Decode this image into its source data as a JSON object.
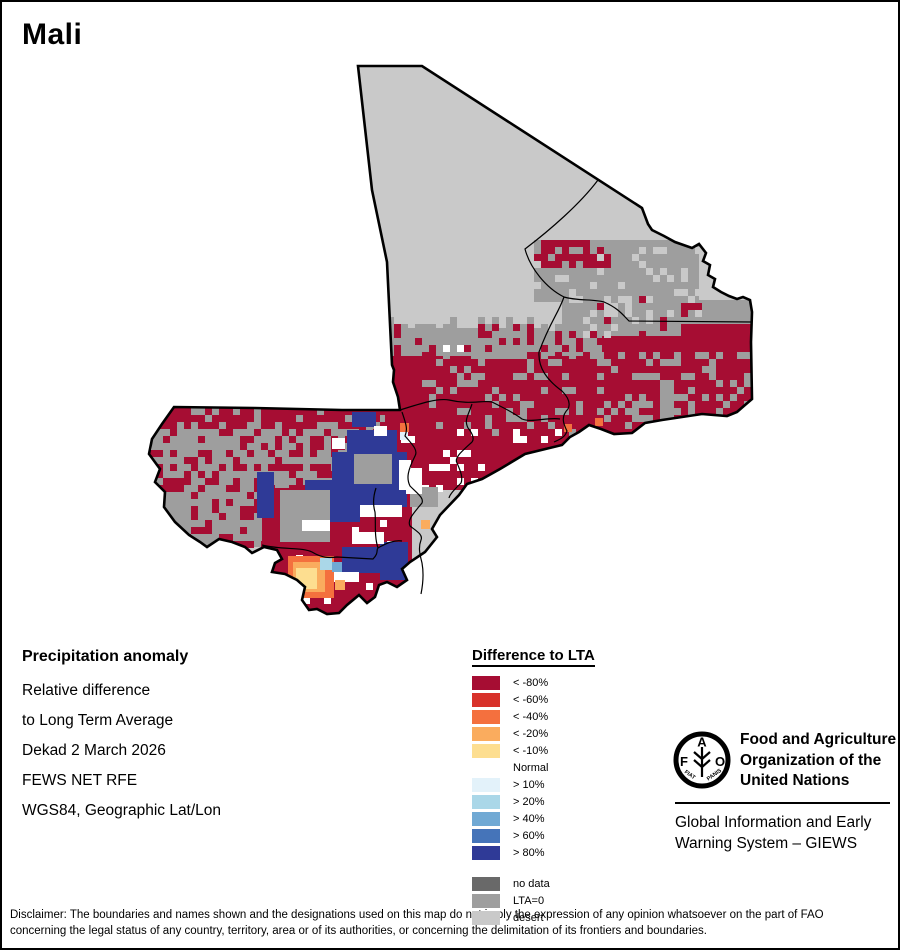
{
  "title": "Mali",
  "info": {
    "heading": "Precipitation anomaly",
    "lines": [
      "Relative difference",
      "to Long Term Average",
      "Dekad 2 March 2026",
      "FEWS NET RFE",
      "WGS84, Geographic Lat/Lon"
    ]
  },
  "legend": {
    "title": "Difference to LTA",
    "entries": [
      {
        "label": "< -80%",
        "color": "#A60D33"
      },
      {
        "label": "< -60%",
        "color": "#D8322B"
      },
      {
        "label": "< -40%",
        "color": "#F4703E"
      },
      {
        "label": "< -20%",
        "color": "#FAAC5E"
      },
      {
        "label": "< -10%",
        "color": "#FDDE90"
      },
      {
        "label": "Normal",
        "color": "#FFFFFF"
      },
      {
        "label": "> 10%",
        "color": "#E3F2FA"
      },
      {
        "label": "> 20%",
        "color": "#AAD7E8"
      },
      {
        "label": "> 40%",
        "color": "#70A9D4"
      },
      {
        "label": "> 60%",
        "color": "#4574B9"
      },
      {
        "label": "> 80%",
        "color": "#2F3A97"
      }
    ],
    "extra_entries": [
      {
        "label": "no data",
        "color": "#696969"
      },
      {
        "label": "LTA=0",
        "color": "#9E9E9E"
      },
      {
        "label": "desert",
        "color": "#C9C9C9"
      }
    ]
  },
  "fao": {
    "logo_letters": [
      "F",
      "A",
      "O"
    ],
    "motto_left": "FIAT",
    "motto_right": "PANIS",
    "org_lines": [
      "Food and Agriculture",
      "Organization of the",
      "United Nations"
    ],
    "giews_lines": [
      "Global Information and Early",
      "Warning System – GIEWS"
    ]
  },
  "disclaimer": {
    "line1": "Disclaimer: The boundaries and names shown and the designations used on this map do not imply the expression of any opinion whatsoever on the part of FAO",
    "line2": "concerning the legal status of any country, territory, area or of its authorities, or concerning the delimitation of its frontiers and boundaries."
  },
  "map": {
    "colors": {
      "desert": "#C9C9C9",
      "lta0": "#9E9E9E",
      "deficit_severe": "#A60D33",
      "surplus_high": "#2F3A97",
      "normal": "#FFFFFF"
    },
    "outline": "M356,64 L420,64 L640,206 L646,222 L650,228 L662,234 L673,240 L690,246 L697,242 L704,251 L701,259 L708,263 L706,273 L713,277 L711,285 L719,290 L727,294 L735,297 L741,295 L748,298 L750,310 L749,340 L750,397 L743,403 L735,410 L725,414 L700,412 L660,418 L643,421 L630,431 L612,432 L599,427 L587,423 L577,430 L568,435 L560,443 L523,452 L498,467 L480,477 L465,482 L457,493 L438,513 L430,527 L435,535 L423,550 L408,560 L400,567 L405,578 L395,585 L385,580 L377,583 L373,595 L365,601 L357,593 L345,603 L337,611 L325,612 L315,607 L307,608 L300,598 L303,585 L295,578 L283,572 L270,570 L273,561 L280,557 L275,548 L262,545 L250,551 L243,545 L230,540 L217,537 L205,545 L198,540 L187,533 L173,520 L162,505 L163,490 L153,480 L158,467 L147,452 L150,437 L160,422 L172,405 L253,406 L340,408 L398,408 L396,395 L391,380 L392,368 L390,363 L385,260 L370,188 Z",
    "boundaries": [
      "M596,178 C578,202 548,228 523,247 C528,266 544,286 562,295 C575,299 592,297 602,300 C616,306 621,313 627,319 L750,320",
      "M562,295 C556,312 548,320 537,350 C536,366 545,378 560,389 C568,397 568,403 566,407 C558,415 562,423 565,429 C563,436 556,438 552,440",
      "M398,408 C420,401 436,396 447,398 C468,403 480,398 490,400 C502,406 512,411 520,417 C530,421 545,415 558,417",
      "M400,410 C404,422 406,427 403,434 C412,444 416,449 413,454 C406,468 404,476 408,484 C416,492 422,496 420,501 C411,512 405,518 408,524 C416,530 421,533 419,538 C416,546 418,553 420,561 C422,572 421,582 419,592",
      "M260,543 C280,548 300,545 310,550 C320,556 327,556 335,555 L371,557 C377,551 374,548 376,546 C386,540 394,538 400,539",
      "M470,402 C466,414 462,418 466,426 C471,432 473,438 469,441 C459,450 452,456 455,461 C459,470 461,476 459,481 C452,488 448,492 447,496",
      "M376,546 C372,534 374,520 373,510 C370,500 372,492 374,486"
    ],
    "solids": [
      {
        "x": 383,
        "y": 326,
        "w": 370,
        "h": 106,
        "c": "#9E9E9E"
      },
      {
        "x": 597,
        "y": 298,
        "w": 156,
        "h": 30,
        "c": "#9E9E9E"
      },
      {
        "x": 150,
        "y": 403,
        "w": 250,
        "h": 142,
        "c": "#9E9E9E"
      },
      {
        "x": 383,
        "y": 354,
        "w": 370,
        "h": 78,
        "c": "#A60D33"
      },
      {
        "x": 600,
        "y": 322,
        "w": 153,
        "h": 34,
        "c": "#A60D33"
      },
      {
        "x": 388,
        "y": 432,
        "w": 180,
        "h": 56,
        "c": "#A60D33"
      },
      {
        "x": 260,
        "y": 486,
        "w": 150,
        "h": 126,
        "c": "#A60D33"
      },
      {
        "x": 532,
        "y": 238,
        "w": 165,
        "h": 62,
        "c": "#9E9E9E"
      },
      {
        "x": 560,
        "y": 296,
        "w": 120,
        "h": 38,
        "c": "#9E9E9E"
      }
    ],
    "speckles": [
      {
        "x": 383,
        "y": 328,
        "w": 370,
        "h": 28,
        "c": "#A60D33",
        "d": 0.32,
        "seed": 21
      },
      {
        "x": 597,
        "y": 300,
        "w": 100,
        "h": 26,
        "c": "#A60D33",
        "d": 0.22,
        "seed": 31
      },
      {
        "x": 420,
        "y": 352,
        "w": 333,
        "h": 82,
        "c": "#9E9E9E",
        "d": 0.2,
        "seed": 22
      },
      {
        "x": 428,
        "y": 334,
        "w": 115,
        "h": 22,
        "c": "#9E9E9E",
        "d": 0.45,
        "seed": 23
      },
      {
        "x": 625,
        "y": 358,
        "w": 95,
        "h": 70,
        "c": "#9E9E9E",
        "d": 0.28,
        "seed": 24
      },
      {
        "x": 150,
        "y": 403,
        "w": 248,
        "h": 24,
        "c": "#A60D33",
        "d": 0.72,
        "seed": 25
      },
      {
        "x": 150,
        "y": 427,
        "w": 248,
        "h": 58,
        "c": "#A60D33",
        "d": 0.4,
        "seed": 26
      },
      {
        "x": 150,
        "y": 485,
        "w": 248,
        "h": 60,
        "c": "#A60D33",
        "d": 0.2,
        "seed": 27
      },
      {
        "x": 265,
        "y": 520,
        "w": 140,
        "h": 90,
        "c": "#FFFFFF",
        "d": 0.06,
        "seed": 28
      },
      {
        "x": 395,
        "y": 430,
        "w": 165,
        "h": 55,
        "c": "#FFFFFF",
        "d": 0.1,
        "seed": 29
      },
      {
        "x": 532,
        "y": 238,
        "w": 168,
        "h": 95,
        "c": "#C9C9C9",
        "d": 0.16,
        "seed": 30
      },
      {
        "x": 536,
        "y": 240,
        "w": 70,
        "h": 26,
        "c": "#A60D33",
        "d": 0.5,
        "seed": 13
      },
      {
        "x": 420,
        "y": 450,
        "w": 52,
        "h": 38,
        "c": "#FFFFFF",
        "d": 0.28,
        "seed": 33
      },
      {
        "x": 390,
        "y": 316,
        "w": 170,
        "h": 14,
        "c": "#9E9E9E",
        "d": 0.25,
        "seed": 35
      },
      {
        "x": 440,
        "y": 330,
        "w": 80,
        "h": 30,
        "c": "#FFFFFF",
        "d": 0.04,
        "seed": 36
      }
    ],
    "patches": [
      {
        "x": 345,
        "y": 428,
        "w": 50,
        "h": 40,
        "c": "#2F3A97"
      },
      {
        "x": 330,
        "y": 450,
        "w": 75,
        "h": 55,
        "c": "#2F3A97"
      },
      {
        "x": 303,
        "y": 478,
        "w": 55,
        "h": 42,
        "c": "#2F3A97"
      },
      {
        "x": 255,
        "y": 470,
        "w": 17,
        "h": 46,
        "c": "#2F3A97"
      },
      {
        "x": 350,
        "y": 410,
        "w": 24,
        "h": 15,
        "c": "#2F3A97"
      },
      {
        "x": 340,
        "y": 545,
        "w": 62,
        "h": 26,
        "c": "#2F3A97"
      },
      {
        "x": 378,
        "y": 540,
        "w": 28,
        "h": 38,
        "c": "#2F3A97"
      },
      {
        "x": 352,
        "y": 452,
        "w": 38,
        "h": 30,
        "c": "#9E9E9E"
      },
      {
        "x": 408,
        "y": 485,
        "w": 28,
        "h": 20,
        "c": "#9E9E9E"
      },
      {
        "x": 278,
        "y": 488,
        "w": 50,
        "h": 52,
        "c": "#9E9E9E"
      },
      {
        "x": 397,
        "y": 458,
        "w": 12,
        "h": 30,
        "c": "#FFFFFF"
      },
      {
        "x": 404,
        "y": 466,
        "w": 16,
        "h": 26,
        "c": "#FFFFFF"
      },
      {
        "x": 358,
        "y": 503,
        "w": 42,
        "h": 12,
        "c": "#FFFFFF"
      },
      {
        "x": 330,
        "y": 436,
        "w": 13,
        "h": 11,
        "c": "#FFFFFF"
      },
      {
        "x": 372,
        "y": 424,
        "w": 13,
        "h": 10,
        "c": "#FFFFFF"
      },
      {
        "x": 300,
        "y": 518,
        "w": 28,
        "h": 11,
        "c": "#FFFFFF"
      },
      {
        "x": 350,
        "y": 530,
        "w": 32,
        "h": 12,
        "c": "#FFFFFF"
      },
      {
        "x": 332,
        "y": 570,
        "w": 25,
        "h": 10,
        "c": "#FFFFFF"
      },
      {
        "x": 286,
        "y": 554,
        "w": 46,
        "h": 42,
        "c": "#F4703E"
      },
      {
        "x": 291,
        "y": 560,
        "w": 32,
        "h": 30,
        "c": "#FAAC5E"
      },
      {
        "x": 294,
        "y": 566,
        "w": 21,
        "h": 21,
        "c": "#FDDE90"
      },
      {
        "x": 333,
        "y": 578,
        "w": 10,
        "h": 10,
        "c": "#FAAC5E"
      },
      {
        "x": 398,
        "y": 421,
        "w": 9,
        "h": 9,
        "c": "#F4703E"
      },
      {
        "x": 562,
        "y": 422,
        "w": 8,
        "h": 8,
        "c": "#F4703E"
      },
      {
        "x": 419,
        "y": 518,
        "w": 9,
        "h": 9,
        "c": "#FAAC5E"
      },
      {
        "x": 593,
        "y": 416,
        "w": 8,
        "h": 8,
        "c": "#F4703E"
      },
      {
        "x": 318,
        "y": 556,
        "w": 12,
        "h": 12,
        "c": "#AAD7E8"
      },
      {
        "x": 330,
        "y": 560,
        "w": 10,
        "h": 10,
        "c": "#70A9D4"
      },
      {
        "x": 398,
        "y": 430,
        "w": 8,
        "h": 8,
        "c": "#E3F2FA"
      }
    ]
  }
}
